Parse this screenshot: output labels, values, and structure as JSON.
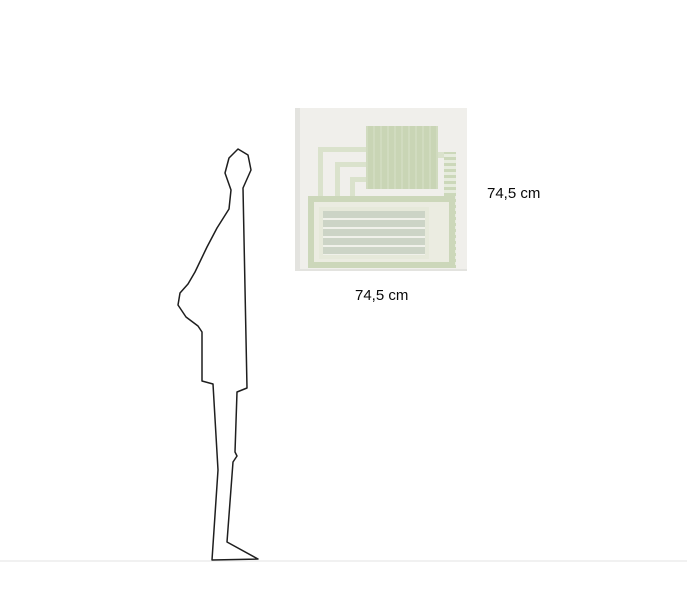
{
  "scale_view": {
    "height_label": "74,5 cm",
    "width_label": "74,5 cm",
    "figure": "standing-human-silhouette-side-profile",
    "artwork_description": "abstract-geometric-print-pale-green"
  },
  "colors": {
    "bg": "#ffffff",
    "line": "#1e1e1e",
    "ground": "#f1f1f1",
    "art-bg": "#f0efeb",
    "art-edge": "#e3e3df",
    "sage": "#c9d5b5",
    "sage-light": "#dae2cc",
    "sage-border": "#ccd7ba",
    "panel": "#e6e9da",
    "band": "#ccd4c6",
    "band-gap": "#f0f1ea",
    "inner": "#ebece1",
    "text": "#0a0a0a"
  }
}
